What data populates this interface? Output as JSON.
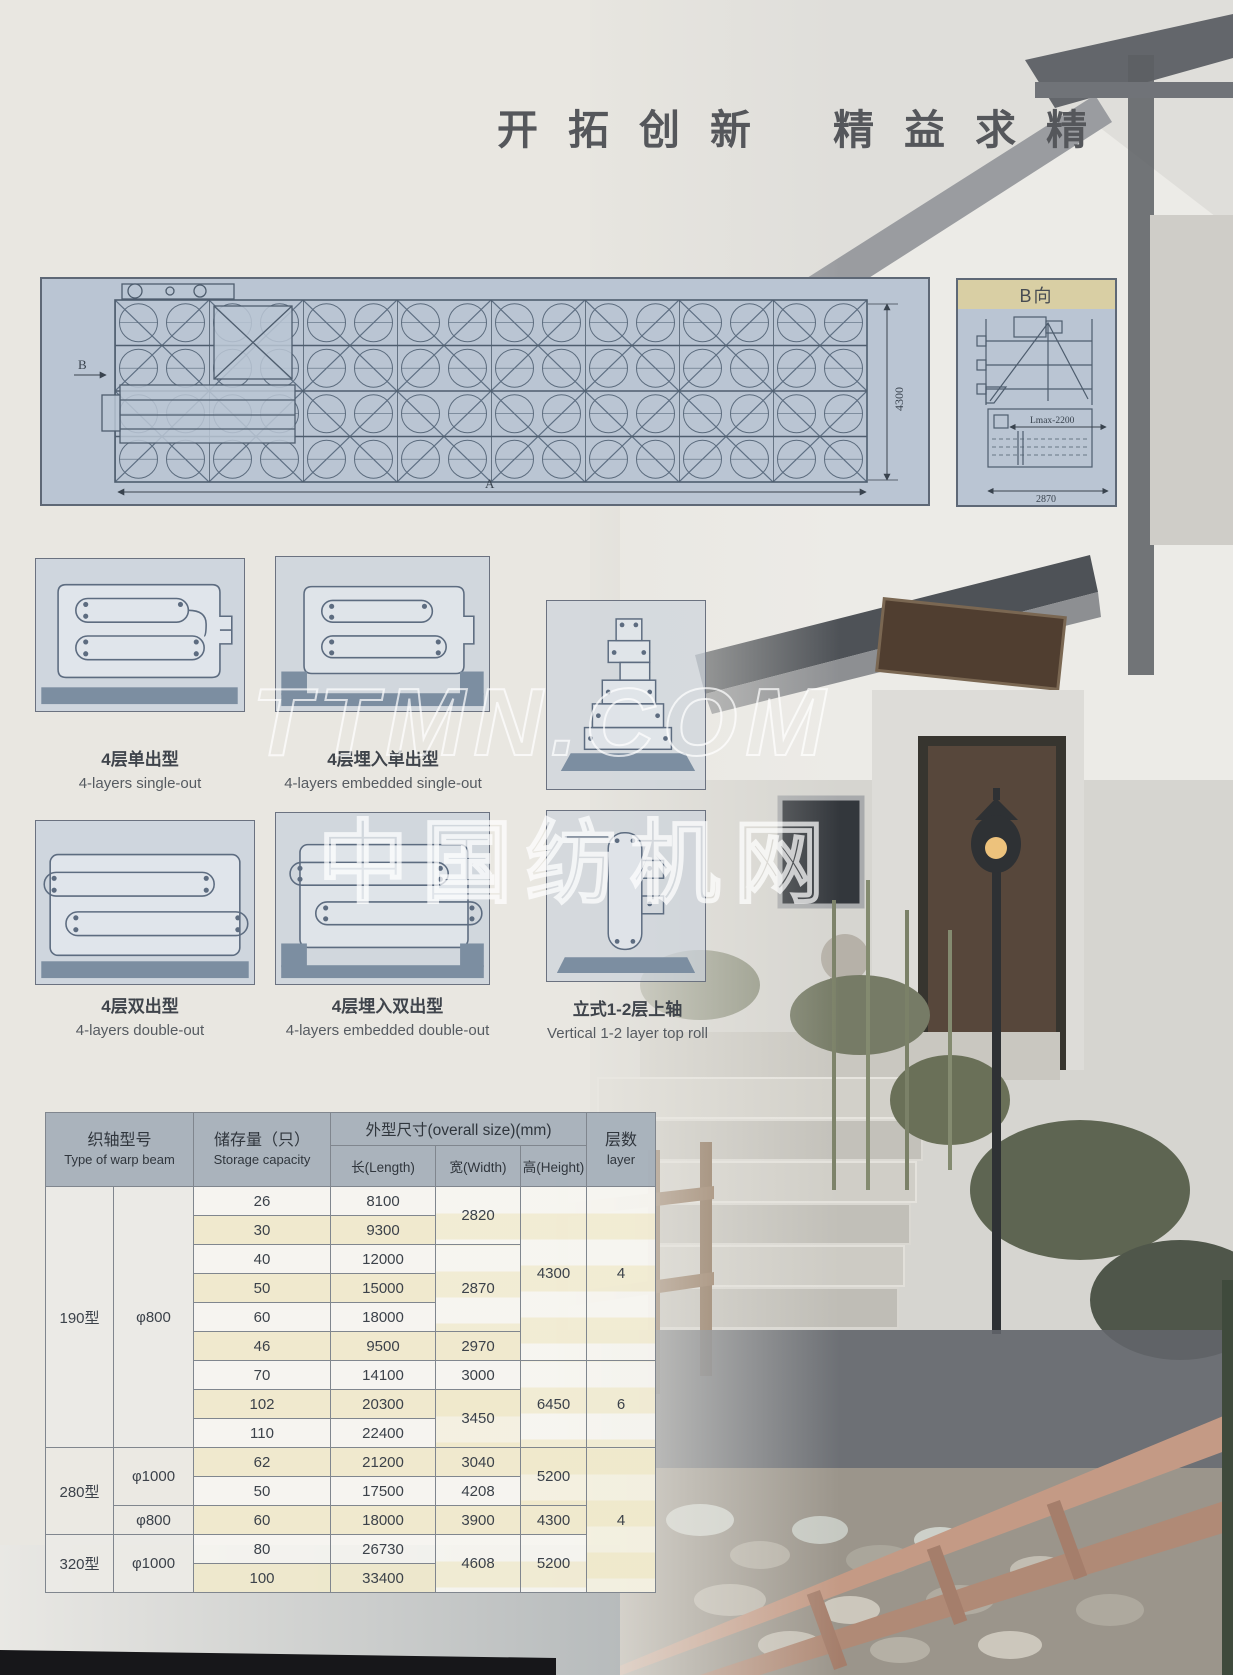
{
  "colors": {
    "paper": "#e9e7e1",
    "blueprint_panel": "#bac5d3",
    "panel_ground_strip": "#7c8ea1",
    "bview_title_bg": "#d9cfa4",
    "table_header_bg": "#a7b1ba",
    "row_beige": "#f0e9cc",
    "drawing_line": "#4e5d6e"
  },
  "header": {
    "slogan_left": "开拓创新",
    "slogan_right": "精益求精"
  },
  "watermark": {
    "line1": "TTMN.COM",
    "line2": "中国纺机网"
  },
  "drawings": {
    "main": {
      "height_dim": "4300",
      "width_label": "A",
      "section_label": "B"
    },
    "b_view": {
      "title": "B向",
      "lmax_dim": "Lmax-2200",
      "width_dim": "2870"
    }
  },
  "configs": [
    {
      "zh": "4层单出型",
      "en": "4-layers single-out"
    },
    {
      "zh": "4层埋入单出型",
      "en": "4-layers embedded single-out"
    },
    {
      "zh": "4层双出型",
      "en": "4-layers double-out"
    },
    {
      "zh": "4层埋入双出型",
      "en": "4-layers embedded double-out"
    },
    {
      "zh": "立式1-2层上轴",
      "en": "Vertical 1-2 layer top roll"
    }
  ],
  "table": {
    "headers": {
      "type_zh": "织轴型号",
      "type_en": "Type of warp beam",
      "capacity_zh": "储存量（只）",
      "capacity_en": "Storage capacity",
      "size_group": "外型尺寸(overall size)(mm)",
      "length": "长(Length)",
      "width": "宽(Width)",
      "height": "高(Height)",
      "layers_zh": "层数",
      "layers_en": "layer"
    },
    "groups": {
      "t190": "190型",
      "t190_dia": "φ800",
      "t280": "280型",
      "t280_dia1": "φ1000",
      "t280_dia2": "φ800",
      "t320": "320型",
      "t320_dia": "φ1000"
    },
    "rows": [
      {
        "cap": "26",
        "len": "8100",
        "wid": "2820",
        "hei": "4300",
        "lay": "4"
      },
      {
        "cap": "30",
        "len": "9300"
      },
      {
        "cap": "40",
        "len": "12000",
        "wid": "2870"
      },
      {
        "cap": "50",
        "len": "15000"
      },
      {
        "cap": "60",
        "len": "18000"
      },
      {
        "cap": "46",
        "len": "9500",
        "wid": "2970"
      },
      {
        "cap": "70",
        "len": "14100",
        "wid": "3000",
        "hei": "6450",
        "lay": "6"
      },
      {
        "cap": "102",
        "len": "20300",
        "wid": "3450"
      },
      {
        "cap": "110",
        "len": "22400"
      },
      {
        "cap": "62",
        "len": "21200",
        "wid": "3040",
        "hei": "5200",
        "lay": "4"
      },
      {
        "cap": "50",
        "len": "17500",
        "wid": "4208"
      },
      {
        "cap": "60",
        "len": "18000",
        "wid": "3900",
        "hei": "4300"
      },
      {
        "cap": "80",
        "len": "26730",
        "wid": "4608",
        "hei": "5200"
      },
      {
        "cap": "100",
        "len": "33400"
      }
    ]
  }
}
